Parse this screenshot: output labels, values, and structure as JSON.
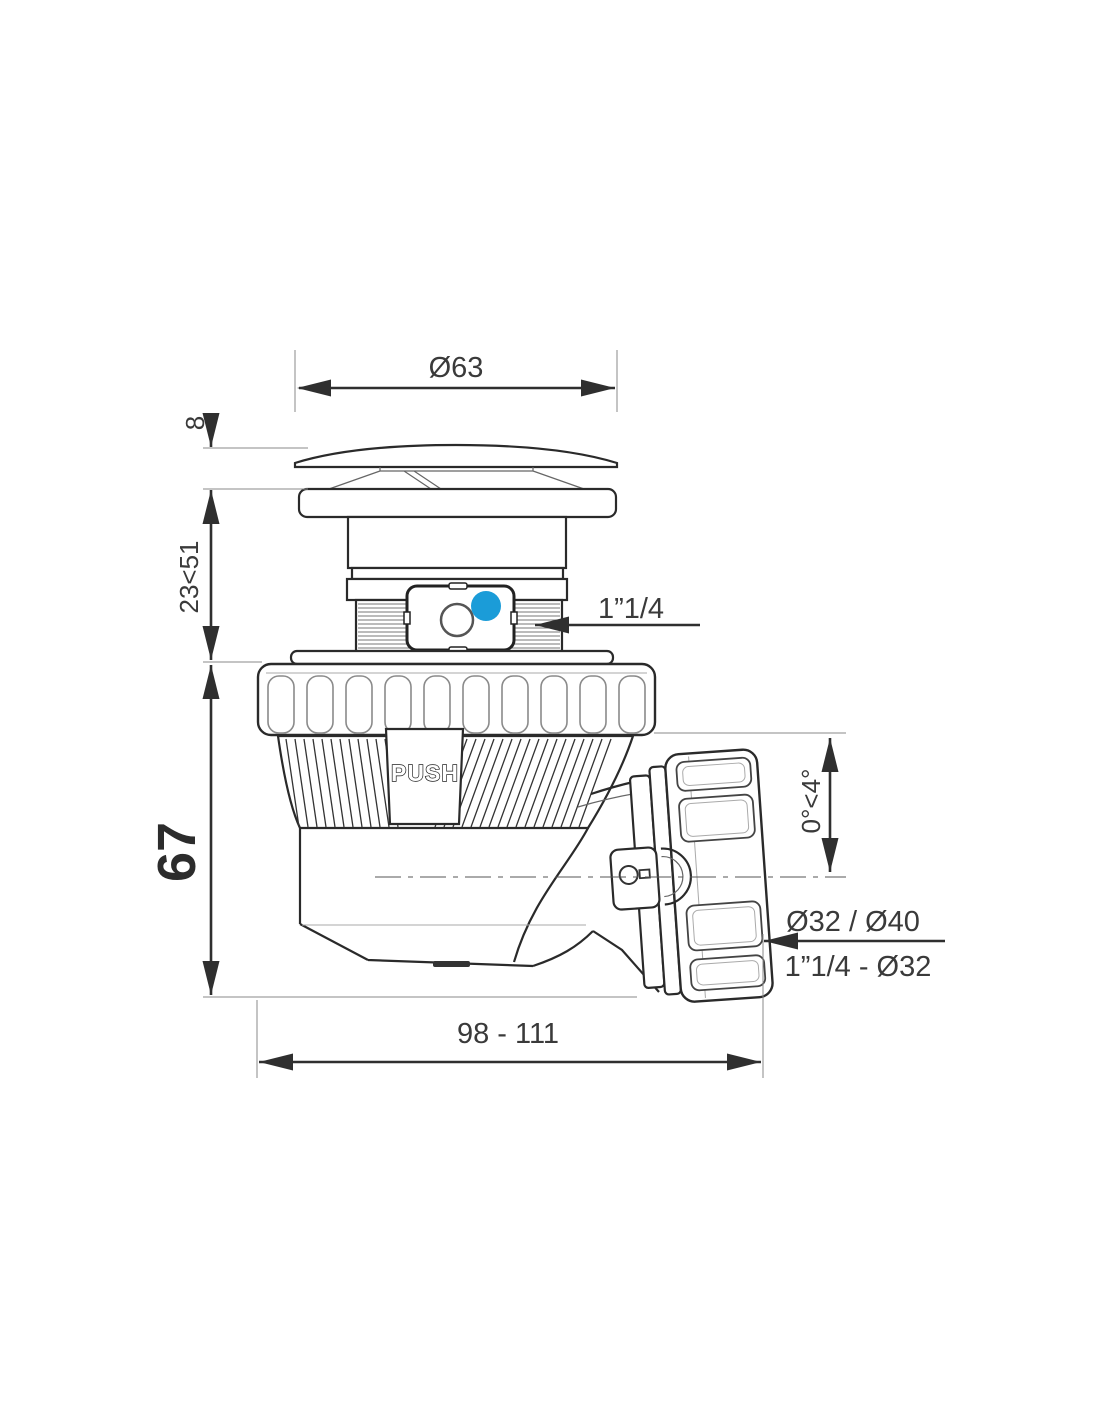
{
  "labels": {
    "dia_top": "Ø63",
    "cap_height": "8",
    "adjust_height": "23<51",
    "body_height": "67",
    "inlet_thread": "1”1/4",
    "angle_range": "0°<4°",
    "outlet_dia": "Ø32 / Ø40",
    "outlet_thread": "1”1/4 - Ø32",
    "length_range": "98 - 111",
    "push": "PUSH"
  },
  "colors": {
    "indicator_blue": "#1b9cd8",
    "line_dark": "#2f2f2f"
  }
}
